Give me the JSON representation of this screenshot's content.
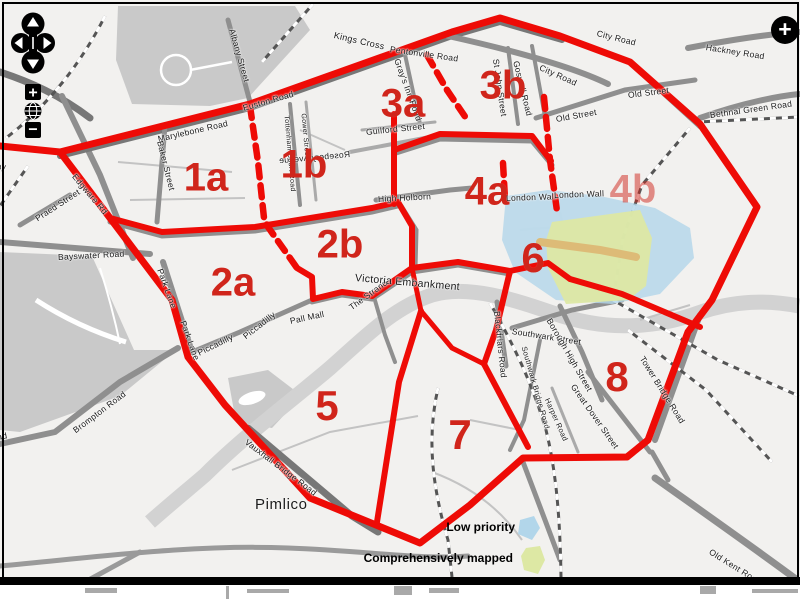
{
  "title": "London mapping-priority zones map",
  "colors": {
    "boundary_red": "#ee0b06",
    "zone_label_red": "#d0251b",
    "low_priority_blue": "#b2d6ea",
    "mapped_green": "#dde8a4",
    "mapped_road_orange": "#ddbb77",
    "park_gray": "#c9c9c9",
    "road_gray": "#8f8f8f",
    "background": "#f2f1ef"
  },
  "zones": [
    {
      "label": "1a",
      "x": 206,
      "y": 178,
      "s": 40,
      "opacity": 1
    },
    {
      "label": "1b",
      "x": 304,
      "y": 165,
      "s": 40,
      "opacity": 1
    },
    {
      "label": "2a",
      "x": 233,
      "y": 283,
      "s": 40,
      "opacity": 1
    },
    {
      "label": "2b",
      "x": 340,
      "y": 245,
      "s": 40,
      "opacity": 1
    },
    {
      "label": "3a",
      "x": 403,
      "y": 104,
      "s": 40,
      "opacity": 1
    },
    {
      "label": "3b",
      "x": 503,
      "y": 86,
      "s": 40,
      "opacity": 1
    },
    {
      "label": "4a",
      "x": 487,
      "y": 192,
      "s": 40,
      "opacity": 1
    },
    {
      "label": "4b",
      "x": 633,
      "y": 190,
      "s": 40,
      "opacity": 0.5
    },
    {
      "label": "5",
      "x": 327,
      "y": 406,
      "s": 42,
      "opacity": 1
    },
    {
      "label": "6",
      "x": 533,
      "y": 258,
      "s": 42,
      "opacity": 1
    },
    {
      "label": "7",
      "x": 460,
      "y": 435,
      "s": 42,
      "opacity": 1
    },
    {
      "label": "8",
      "x": 617,
      "y": 377,
      "s": 42,
      "opacity": 1
    }
  ],
  "streets": [
    {
      "t": "Westway",
      "x": -30,
      "y": 158,
      "r": 6
    },
    {
      "t": "Praed Street",
      "x": 36,
      "y": 214,
      "r": -33
    },
    {
      "t": "Edgware Rd",
      "x": 74,
      "y": 170,
      "r": 50
    },
    {
      "t": "Marylebone Road",
      "x": 158,
      "y": 134,
      "r": -13
    },
    {
      "t": "Baker Street",
      "x": 160,
      "y": 136,
      "r": 76
    },
    {
      "t": "Albany Street",
      "x": 232,
      "y": 24,
      "r": 74
    },
    {
      "t": "Euston Road",
      "x": 243,
      "y": 103,
      "r": -16
    },
    {
      "t": "Kings Cross",
      "x": 334,
      "y": 30,
      "r": 13,
      "s": 9
    },
    {
      "t": "Pentonville Road",
      "x": 390,
      "y": 44,
      "r": 8
    },
    {
      "t": "Gray's Inn Road",
      "x": 397,
      "y": 54,
      "r": 70
    },
    {
      "t": "City Road",
      "x": 540,
      "y": 62,
      "r": 24
    },
    {
      "t": "City Road",
      "x": 597,
      "y": 28,
      "r": 14
    },
    {
      "t": "Goswell Road",
      "x": 516,
      "y": 56,
      "r": 76
    },
    {
      "t": "St John Street",
      "x": 496,
      "y": 54,
      "r": 82
    },
    {
      "t": "Old Street",
      "x": 556,
      "y": 114,
      "r": -10
    },
    {
      "t": "Old Street",
      "x": 628,
      "y": 90,
      "r": -7
    },
    {
      "t": "Hackney Road",
      "x": 706,
      "y": 42,
      "r": 9
    },
    {
      "t": "Bethnal Green Road",
      "x": 710,
      "y": 110,
      "r": -8
    },
    {
      "t": "Guilford Street",
      "x": 366,
      "y": 127,
      "r": -6
    },
    {
      "t": "Rosebery Avenue",
      "x": 350,
      "y": 149,
      "r": -5,
      "m": true
    },
    {
      "t": "High Holborn",
      "x": 378,
      "y": 194,
      "r": -3
    },
    {
      "t": "London Wall",
      "x": 506,
      "y": 193,
      "r": -2
    },
    {
      "t": "London Wall",
      "x": 554,
      "y": 190,
      "r": -2
    },
    {
      "t": "Bayswater Road",
      "x": 58,
      "y": 252,
      "r": -3
    },
    {
      "t": "Park Lane",
      "x": 160,
      "y": 264,
      "r": 70
    },
    {
      "t": "Park Lane",
      "x": 183,
      "y": 316,
      "r": 70
    },
    {
      "t": "Piccadilly",
      "x": 198,
      "y": 348,
      "r": -26
    },
    {
      "t": "Piccadilly",
      "x": 244,
      "y": 332,
      "r": -38
    },
    {
      "t": "Pall Mall",
      "x": 290,
      "y": 316,
      "r": -12
    },
    {
      "t": "The Strand",
      "x": 350,
      "y": 303,
      "r": -36
    },
    {
      "t": "Victoria Embankment",
      "x": 355,
      "y": 272,
      "r": 5,
      "s": 10.5
    },
    {
      "t": "Blackfriars Road",
      "x": 497,
      "y": 306,
      "r": 84
    },
    {
      "t": "Southwark Street",
      "x": 512,
      "y": 326,
      "r": 9
    },
    {
      "t": "Borough High Street",
      "x": 549,
      "y": 314,
      "r": 60
    },
    {
      "t": "Southwark Bridge Road",
      "x": 524,
      "y": 342,
      "r": 74,
      "s": 7.5
    },
    {
      "t": "Great Dover Street",
      "x": 573,
      "y": 380,
      "r": 55
    },
    {
      "t": "Harper Road",
      "x": 547,
      "y": 394,
      "r": 66,
      "s": 7.5
    },
    {
      "t": "Tower Bridge Road",
      "x": 642,
      "y": 352,
      "r": 58
    },
    {
      "t": "Vauxhall Bridge Road",
      "x": 246,
      "y": 436,
      "r": 37
    },
    {
      "t": "Brompton Road",
      "x": 74,
      "y": 426,
      "r": -37
    },
    {
      "t": "Old Kent Road",
      "x": 710,
      "y": 546,
      "r": 32
    },
    {
      "t": "Road",
      "x": -14,
      "y": 434,
      "r": -10
    },
    {
      "t": "Tottenham Court Road",
      "x": 286,
      "y": 112,
      "r": 85,
      "s": 7
    },
    {
      "t": "Gower Street",
      "x": 303,
      "y": 110,
      "r": 85,
      "s": 7
    }
  ],
  "places": [
    {
      "t": "Pimlico",
      "x": 255,
      "y": 496
    }
  ],
  "legend": {
    "items": [
      {
        "label": "Low priority",
        "color": "#b2d6ea"
      },
      {
        "label": "Comprehensively mapped",
        "color": "#dde8a4"
      }
    ]
  },
  "controls": {
    "zoom_in": "+",
    "zoom_out": "−",
    "maximize": "+",
    "icons": [
      "pan-arrows-icon",
      "plus-icon",
      "globe-icon",
      "minus-icon",
      "maximize-plus-icon"
    ]
  }
}
